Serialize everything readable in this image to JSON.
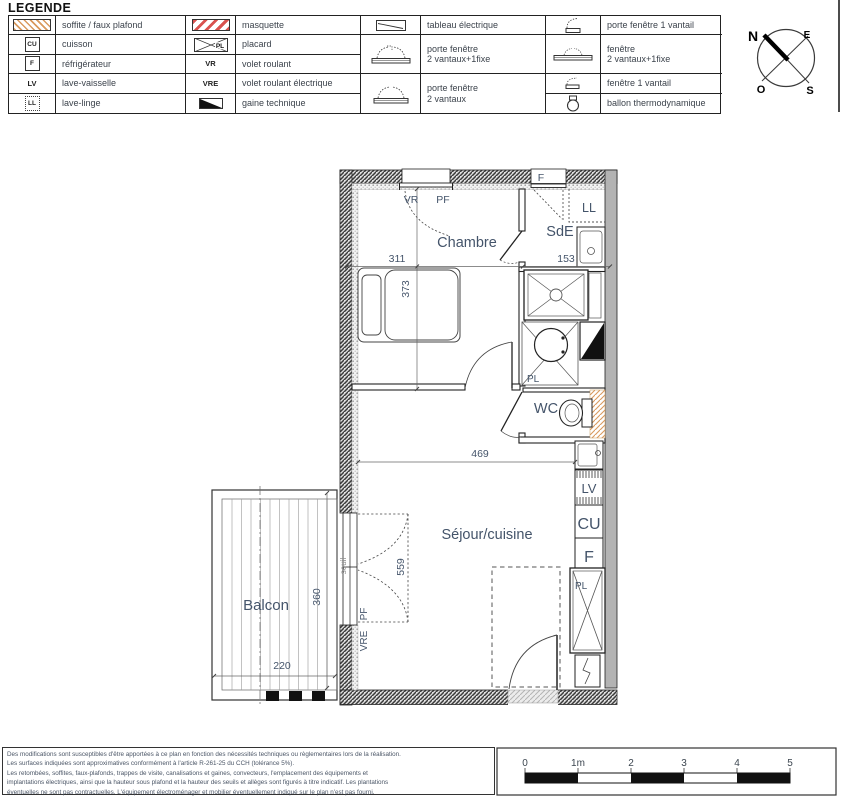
{
  "colors": {
    "accent": "#44546a",
    "wall_dark": "#3a3a3a",
    "party_wall_gray": "#b3b3b3",
    "soffite_orange": "#d99a5e",
    "masquette_red": "#d9534f"
  },
  "legend": {
    "title": "LEGENDE",
    "columns": [
      {
        "rows": [
          {
            "sym": "soffite-hatch",
            "sym_text": "",
            "label": "soffite / faux plafond"
          },
          {
            "sym": "box",
            "sym_text": "CU",
            "label": "cuisson"
          },
          {
            "sym": "box",
            "sym_text": "F",
            "label": "réfrigérateur"
          },
          {
            "sym": "text",
            "sym_text": "LV",
            "label": "lave-vaisselle"
          },
          {
            "sym": "dotted-box",
            "sym_text": "LL",
            "label": "lave-linge"
          }
        ]
      },
      {
        "rows": [
          {
            "sym": "masquette-hatch",
            "sym_text": "",
            "label": "masquette"
          },
          {
            "sym": "placard",
            "sym_text": "PL",
            "label": "placard"
          },
          {
            "sym": "text",
            "sym_text": "VR",
            "label": "volet roulant"
          },
          {
            "sym": "text",
            "sym_text": "VRE",
            "label": "volet roulant électrique"
          },
          {
            "sym": "gaine",
            "sym_text": "",
            "label": "gaine technique"
          }
        ]
      },
      {
        "rows": [
          {
            "sym": "tableau",
            "sym_text": "",
            "label": "tableau électrique"
          },
          {
            "sym": "porte-fenetre-2v1f",
            "sym_text": "",
            "label": "porte fenêtre\n2 vantaux+1fixe"
          },
          {
            "sym": "porte-fenetre-2v",
            "sym_text": "",
            "label": "porte fenêtre\n2 vantaux"
          }
        ]
      },
      {
        "rows": [
          {
            "sym": "porte-fenetre-1v",
            "sym_text": "",
            "label": "porte fenêtre 1 vantail"
          },
          {
            "sym": "fenetre-2v1f",
            "sym_text": "",
            "label": "fenêtre\n2 vantaux+1fixe"
          },
          {
            "sym": "fenetre-1v",
            "sym_text": "",
            "label": "fenêtre 1 vantail"
          },
          {
            "sym": "ballon",
            "sym_text": "",
            "label": "ballon thermodynamique"
          }
        ]
      }
    ]
  },
  "compass": {
    "n": "N",
    "e": "E",
    "o": "O",
    "s": "S"
  },
  "plan": {
    "rooms": {
      "chambre": "Chambre",
      "sde": "SdE",
      "wc": "WC",
      "sejour": "Séjour/cuisine",
      "balcon": "Balcon"
    },
    "dims": {
      "d311": "311",
      "d373": "373",
      "d153": "153",
      "d469": "469",
      "d559": "559",
      "d360": "360",
      "d220": "220"
    },
    "tags": {
      "vr": "VR",
      "pf_top": "PF",
      "f_win": "F",
      "ll": "LL",
      "pl_bath": "PL",
      "pl_closet": "PL",
      "lv": "LV",
      "cu": "CU",
      "f_fridge": "F",
      "pf_balcony": "PF",
      "vre": "VRE",
      "seuil": "seuil"
    }
  },
  "scalebar": {
    "ticks": [
      "0",
      "1m",
      "2",
      "3",
      "4",
      "5"
    ]
  },
  "footer": {
    "lines": [
      "Des modifications sont susceptibles d'être apportées à ce plan en fonction des nécessités techniques ou règlementaires lors de la réalisation.",
      "Les surfaces indiquées sont approximatives conformément à l'article R-261-25 du CCH (tolérance 5%).",
      "Les retombées, soffites, faux-plafonds, trappes de visite, canalisations et gaines, convecteurs, l'emplacement des équipements et",
      "implantations électriques, ainsi que la hauteur sous plafond et la hauteur des seuils et allèges sont figurés à titre indicatif. Les plantations",
      "éventuelles ne sont pas contractuelles. L'équipement électroménager et mobilier éventuellement indiqué sur le plan n'est pas fourni."
    ]
  }
}
